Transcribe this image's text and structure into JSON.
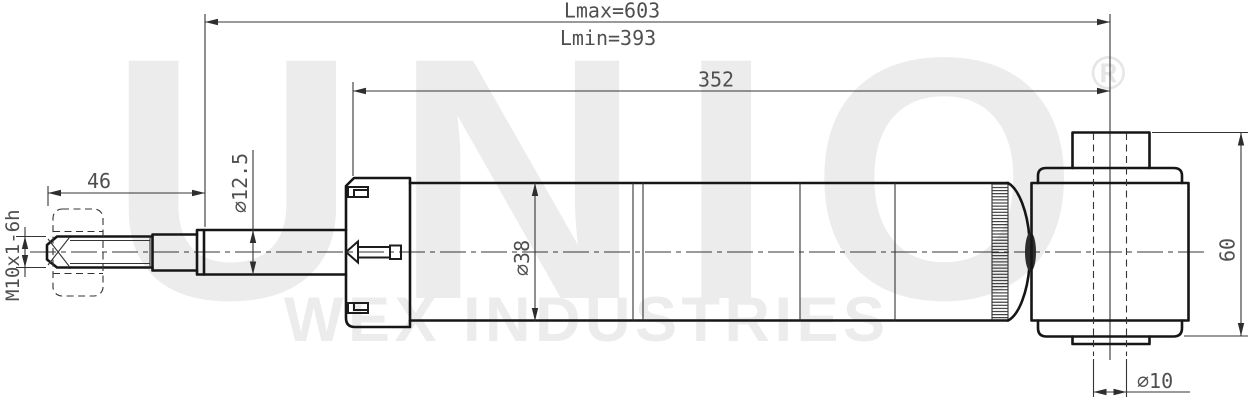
{
  "drawing": {
    "dimensions": {
      "lmax": "Lmax=603",
      "lmin": "Lmin=393",
      "body_length": "352",
      "stud_length": "46",
      "rod_diameter": "⌀12.5",
      "thread_spec": "M10x1-6h",
      "body_diameter": "⌀38",
      "mount_height": "60",
      "pin_diameter": "⌀10"
    },
    "watermark": {
      "brand": "UNIO",
      "registered": "®",
      "subtitle": "WEX INDUSTRIES"
    },
    "colors": {
      "line": "#161616",
      "dimension_text": "#4f4f4f",
      "watermark": "#ececec",
      "background": "#ffffff"
    }
  }
}
